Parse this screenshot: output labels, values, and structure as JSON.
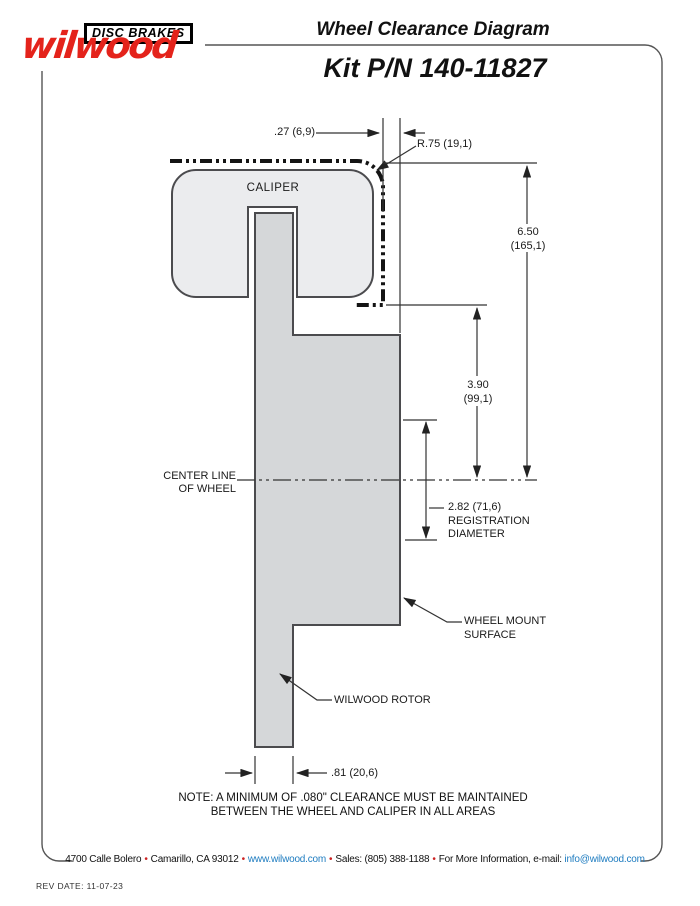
{
  "header": {
    "brand_script": "wilwood",
    "brand_tagline": "DISC BRAKES",
    "title": "Wheel Clearance Diagram",
    "kit_number": "Kit P/N 140-11827"
  },
  "diagram": {
    "caliper_label": "CALIPER",
    "centerline_label_line1": "CENTER LINE",
    "centerline_label_line2": "OF WHEEL",
    "dims": {
      "caliper_clearance": ".27 (6,9)",
      "corner_radius": "R.75 (19,1)",
      "wheel_radius_in": "6.50",
      "wheel_radius_mm": "(165,1)",
      "caliper_to_centerline_in": "3.90",
      "caliper_to_centerline_mm": "(99,1)",
      "registration_value": "2.82 (71,6)",
      "registration_word1": "REGISTRATION",
      "registration_word2": "DIAMETER",
      "rotor_width": ".81 (20,6)"
    },
    "labels": {
      "wheel_mount_line1": "WHEEL MOUNT",
      "wheel_mount_line2": "SURFACE",
      "rotor": "WILWOOD ROTOR"
    },
    "note_line1": "NOTE: A MINIMUM OF .080\" CLEARANCE MUST BE MAINTAINED",
    "note_line2": "BETWEEN THE WHEEL AND CALIPER IN ALL AREAS"
  },
  "footer": {
    "address": "4700 Calle Bolero",
    "city": "Camarillo, CA 93012",
    "website": "www.wilwood.com",
    "sales": "Sales: (805) 388-1188",
    "info_prefix": "For More Information, e-mail:",
    "email": "info@wilwood.com",
    "separator": "•",
    "rev_date": "REV DATE:  11-07-23"
  },
  "colors": {
    "brand_red": "#e4231b",
    "link_blue": "#1e7cc0",
    "caliper_fill": "#ebecee",
    "rotor_fill": "#d5d7d9",
    "line_dark": "#333333"
  }
}
